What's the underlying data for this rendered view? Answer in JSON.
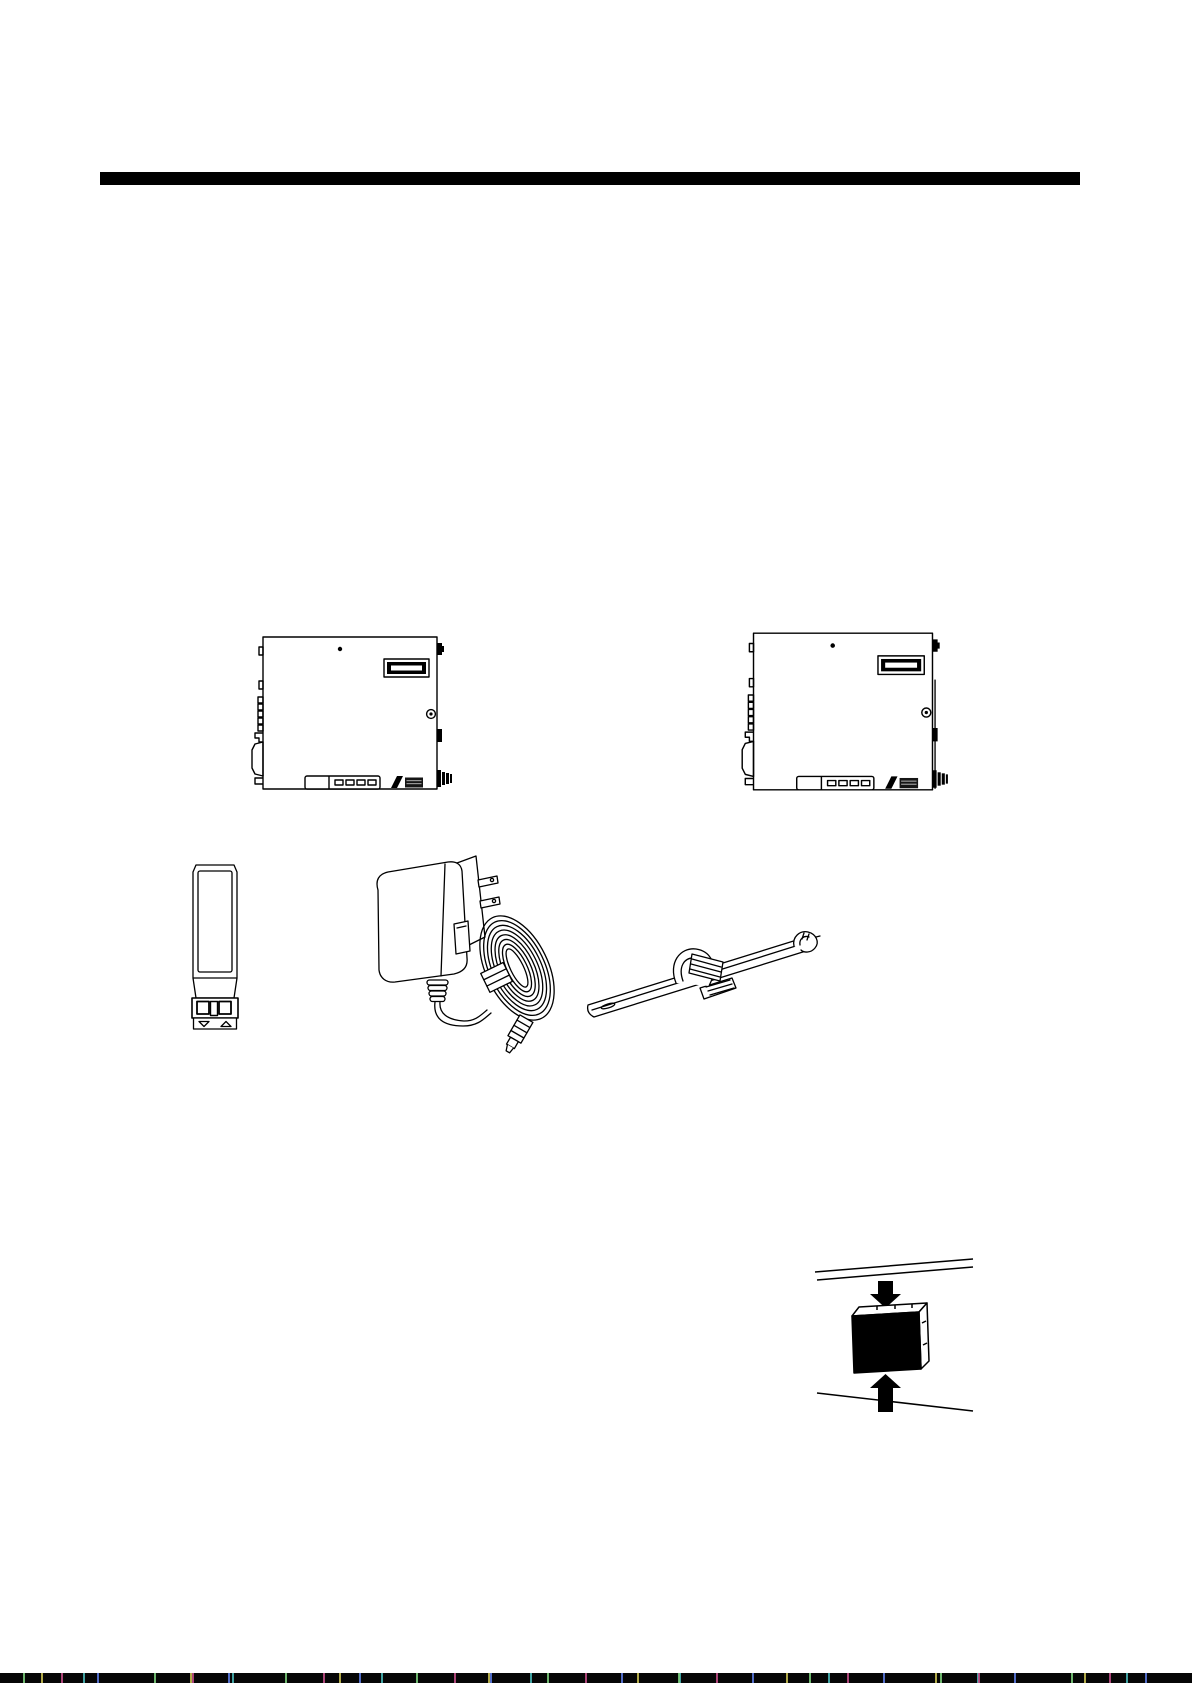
{
  "page": {
    "paper_color": "#ffffff",
    "ink_color": "#000000",
    "kind": "hardware manual page, line-art figures only, no visible body text"
  },
  "header_rule": {
    "label": "chapter divider bar",
    "color": "#000000"
  },
  "figures": {
    "device_left": {
      "label": "media converter chassis, front view, left unit"
    },
    "device_right": {
      "label": "media converter chassis, front view, right unit with side panel seam"
    },
    "sfp_module": {
      "label": "SFP fiber transceiver module with duplex LC connector"
    },
    "power_adapter": {
      "label": "AC wall power adapter with coiled cord and barrel plug"
    },
    "cable_clamp": {
      "label": "adjustable cable tie clamp"
    },
    "insertion_diagram": {
      "label": "unit pressed between mounting rails, arrows above and below"
    }
  },
  "branding": {
    "logo": {
      "label": "manufacturer logo mark"
    }
  },
  "footer": {
    "artifact": {
      "label": "scan edge noise strip"
    }
  }
}
